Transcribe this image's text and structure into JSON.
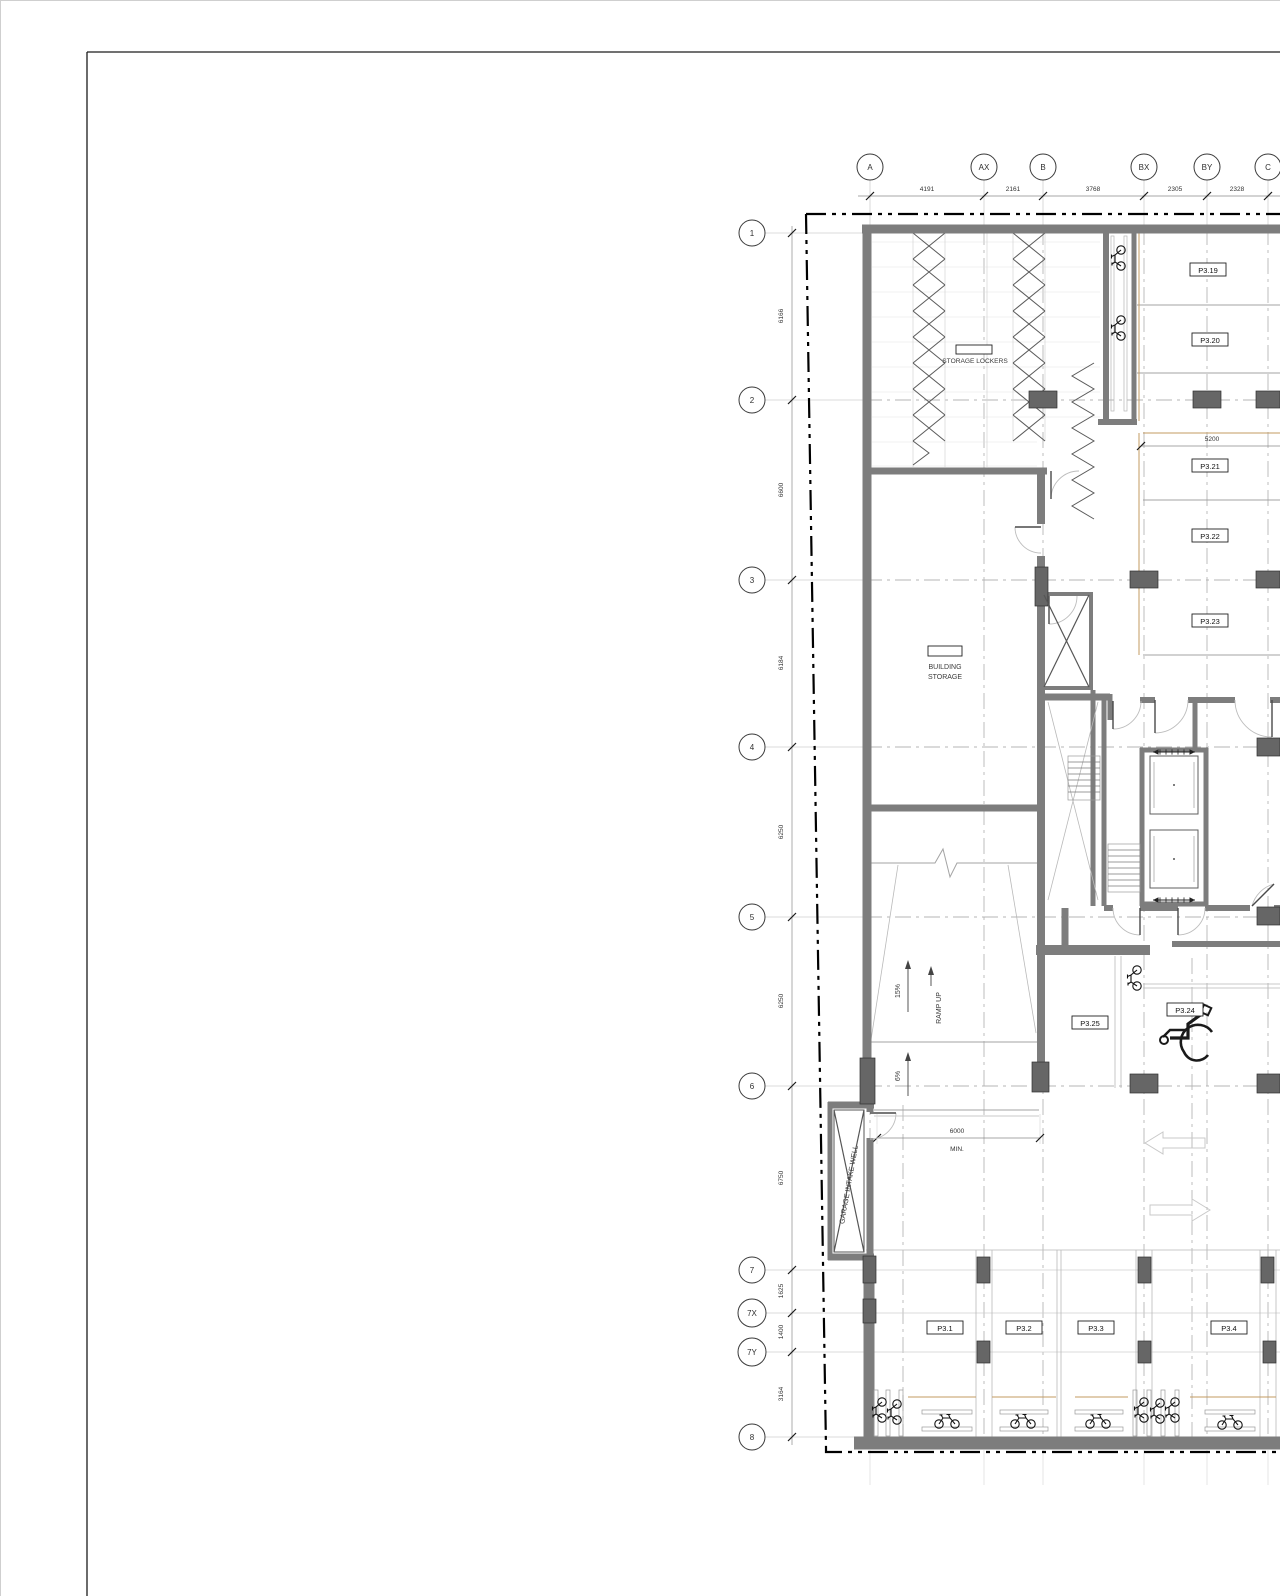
{
  "grid": {
    "top": {
      "labels": [
        "A",
        "AX",
        "B",
        "BX",
        "BY",
        "C"
      ],
      "dims": [
        "4191",
        "2161",
        "3768",
        "2305",
        "2328"
      ]
    },
    "side": {
      "labels": [
        "1",
        "2",
        "3",
        "4",
        "5",
        "6",
        "7",
        "7X",
        "7Y",
        "8"
      ],
      "dims": [
        "6166",
        "6600",
        "6184",
        "6250",
        "6250",
        "6750",
        "1625",
        "1400",
        "3164"
      ]
    }
  },
  "rooms": {
    "storage_lockers": "STORAGE LOCKERS",
    "building_storage_1": "BUILDING",
    "building_storage_2": "STORAGE",
    "garage_intake_well": "GARAGE INTAKE WELL"
  },
  "ramp": {
    "upper_slope": "15%",
    "lower_slope": "6%",
    "label": "RAMP UP",
    "width_dim": "6000",
    "width_qual": "MIN."
  },
  "dims": {
    "stall_depth": "5200"
  },
  "stalls": {
    "right": [
      "P3.19",
      "P3.20",
      "P3.21",
      "P3.22",
      "P3.23"
    ],
    "center": {
      "regular": "P3.25",
      "accessible": "P3.24"
    },
    "bottom": [
      "P3.1",
      "P3.2",
      "P3.3",
      "P3.4"
    ]
  }
}
